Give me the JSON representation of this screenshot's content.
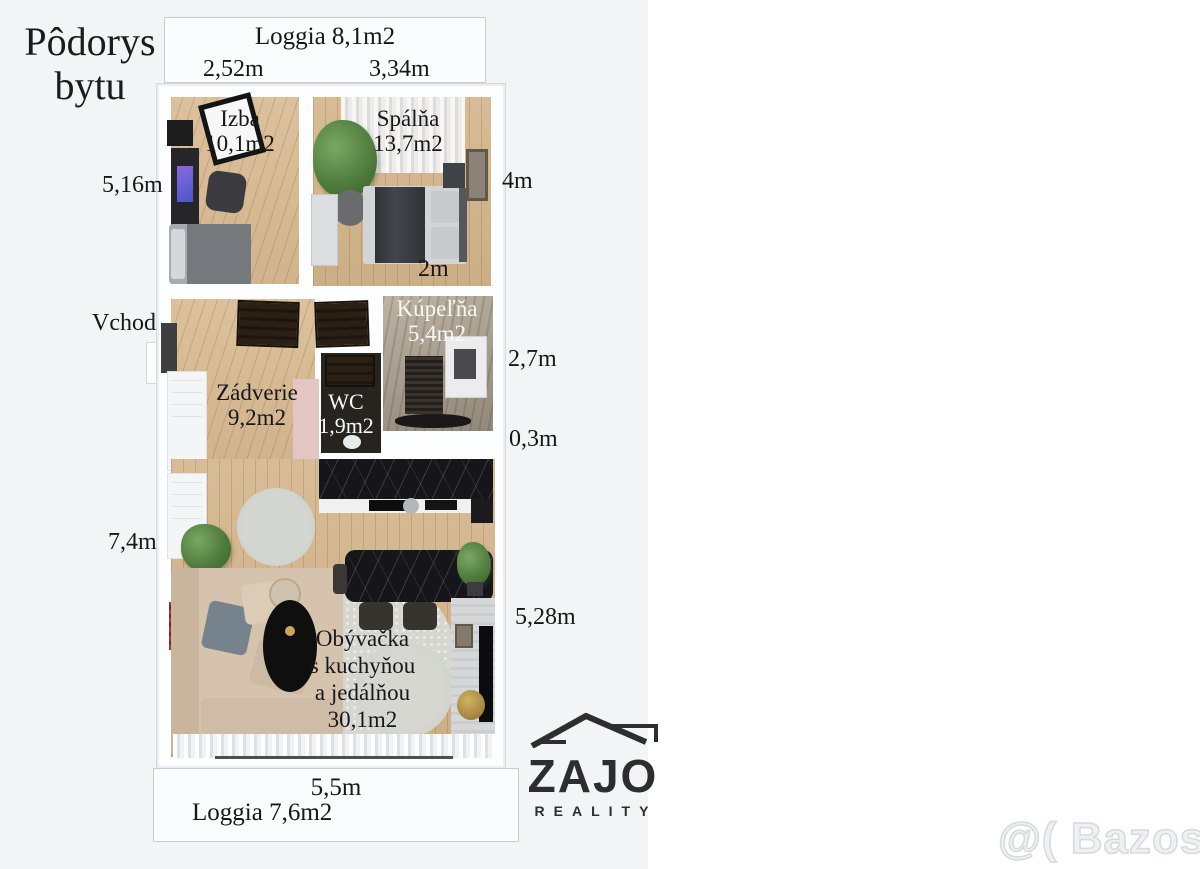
{
  "title": {
    "line1": "Pôdorys",
    "line2": "bytu"
  },
  "loggia_top": {
    "label": "Loggia 8,1m2",
    "dim_left": "2,52m",
    "dim_right": "3,34m"
  },
  "rooms": {
    "izba": {
      "name": "Izba",
      "area": "10,1m2"
    },
    "spalna": {
      "name": "Spálňa",
      "area": "13,7m2"
    },
    "kupelna": {
      "name": "Kúpeľňa",
      "area": "5,4m2"
    },
    "wc": {
      "name": "WC",
      "area": "1,9m2"
    },
    "zadverie": {
      "name": "Zádverie",
      "area": "9,2m2"
    },
    "obyvacka": {
      "name_line1": "Obývačka",
      "name_line2": "s kuchyňou",
      "name_line3": "a jedálňou",
      "area": "30,1m2"
    }
  },
  "dimensions": {
    "left_wall": "5,16m",
    "left_lower": "7,4m",
    "right_bedroom": "4m",
    "spalna_width": "2m",
    "bathroom": "2,7m",
    "wall_offset": "0,3m",
    "living": "5,28m",
    "bottom": "5,5m"
  },
  "entrance": {
    "label": "Vchod"
  },
  "loggia_bottom": {
    "label": "Loggia 7,6m2"
  },
  "logo": {
    "name": "ZAJO",
    "subtitle": "REALITY"
  },
  "watermark": {
    "text": "@( Bazos.sk"
  },
  "colors": {
    "photo_bg": "#f3f4f6",
    "wall": "#fcfdfe",
    "wood": "#d2b691",
    "kitchen_marble": "#16161a",
    "bathroom_stone": "#a99f92"
  }
}
